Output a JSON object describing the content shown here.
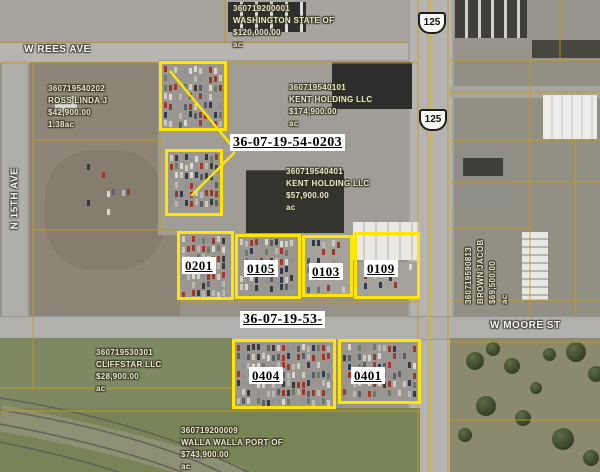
{
  "streets": {
    "rees": "W REES AVE",
    "fifteenth": "N 15TH AVE",
    "moore": "W MOORE ST"
  },
  "shields": {
    "route": "125"
  },
  "labels": {
    "sec54": "36-07-19-54-0203",
    "sec53": "36-07-19-53-",
    "lot0201": "0201",
    "lot0105": "0105",
    "lot0103": "0103",
    "lot0109": "0109",
    "lot0404": "0404",
    "lot0401": "0401"
  },
  "parcels": {
    "washington": {
      "id": "360719200001",
      "owner": "WASHINGTON STATE OF",
      "value": "$120,000.00",
      "acres": "ac"
    },
    "ross": {
      "id": "360719540202",
      "owner": "ROSS LINDA J",
      "value": "$42,900.00",
      "acres": "1.38ac"
    },
    "kent1": {
      "id": "360719540101",
      "owner": "KENT HOLDING LLC",
      "value": "$174,900.00",
      "acres": "ac"
    },
    "kent2": {
      "id": "360719540401",
      "owner": "KENT HOLDING LLC",
      "value": "$57,900.00",
      "acres": "ac"
    },
    "cliffstar": {
      "id": "360719530301",
      "owner": "CLIFFSTAR LLC",
      "value": "$28,900.00",
      "acres": "ac"
    },
    "port": {
      "id": "360719200009",
      "owner": "WALLA WALLA PORT OF",
      "value": "$743,900.00",
      "acres": "ac"
    },
    "brown": {
      "id": "360719590813",
      "owner": "BROWN JACOB",
      "value": "$69,500.00",
      "acres": "ac"
    }
  },
  "colors": {
    "parcel_highlight": "#ffe600",
    "cadastral_line": "#c8991c",
    "label_background": "#ffffff",
    "label_text": "#000000",
    "annotation_text": "#ece7d2",
    "road": "#b6b4b0",
    "field_green": "#7e8862"
  }
}
